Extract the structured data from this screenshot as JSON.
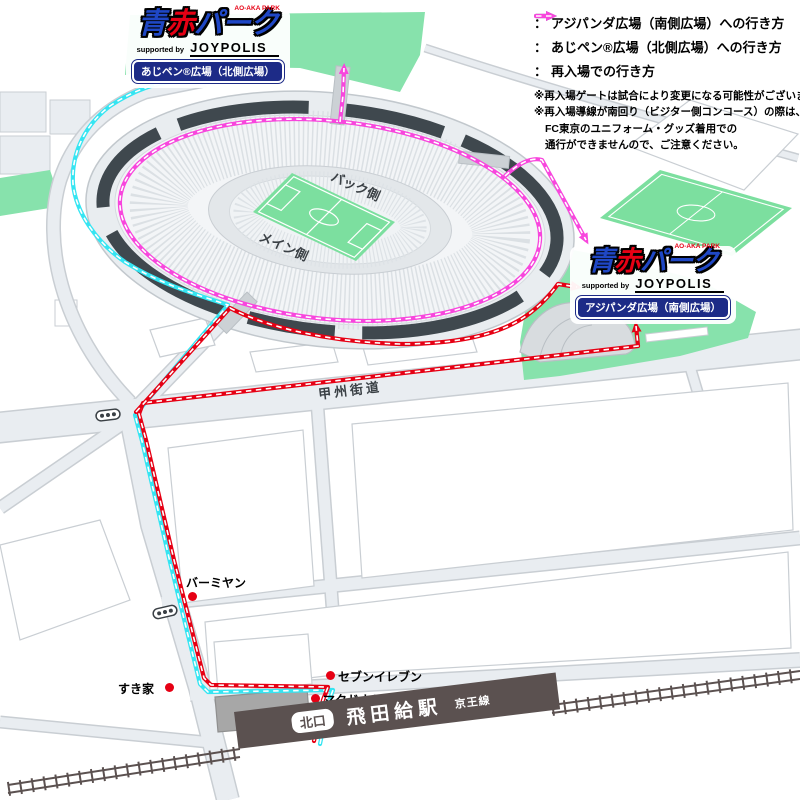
{
  "colors": {
    "red": "#e60014",
    "cyan": "#35e5f2",
    "magenta": "#f846dd",
    "plaza_green": "#87e2ac",
    "pitch_green": "#7cdf9f",
    "label_blue": "#1d2b87",
    "station_brown": "#5b5150"
  },
  "legend": {
    "items": [
      {
        "color_key": "red",
        "label": "アジパンダ広場（南側広場）への行き方"
      },
      {
        "color_key": "cyan",
        "label": "あじペン®広場（北側広場）への行き方"
      },
      {
        "color_key": "magenta",
        "label": "再入場での行き方"
      }
    ],
    "notes": [
      "※再入場ゲートは試合により変更になる可能性がございます。",
      "※再入場導線が南回り（ビジター側コンコース）の際は、",
      "FC東京のユニフォーム・グッズ着用での",
      "通行ができませんので、ご注意ください。"
    ]
  },
  "logo": {
    "ao": "青",
    "aka": "赤",
    "park": "パーク",
    "romaji": "AO-AKA PARK",
    "supported_by": "supported by",
    "sponsor": "JOYPOLIS"
  },
  "plazas": {
    "north_label": "あじペン®広場（北側広場）",
    "south_label": "アジパンダ広場（南側広場）"
  },
  "stadium": {
    "back_side": "バック側",
    "main_side": "メイン側"
  },
  "roads": {
    "koshu_kaido": "甲州街道"
  },
  "pois": [
    {
      "label": "バーミヤン"
    },
    {
      "label": "すき家"
    },
    {
      "label": "セブンイレブン"
    },
    {
      "label": "マクドナルド"
    }
  ],
  "station": {
    "exit": "北口",
    "name": "飛田給駅",
    "line": "京王線"
  }
}
